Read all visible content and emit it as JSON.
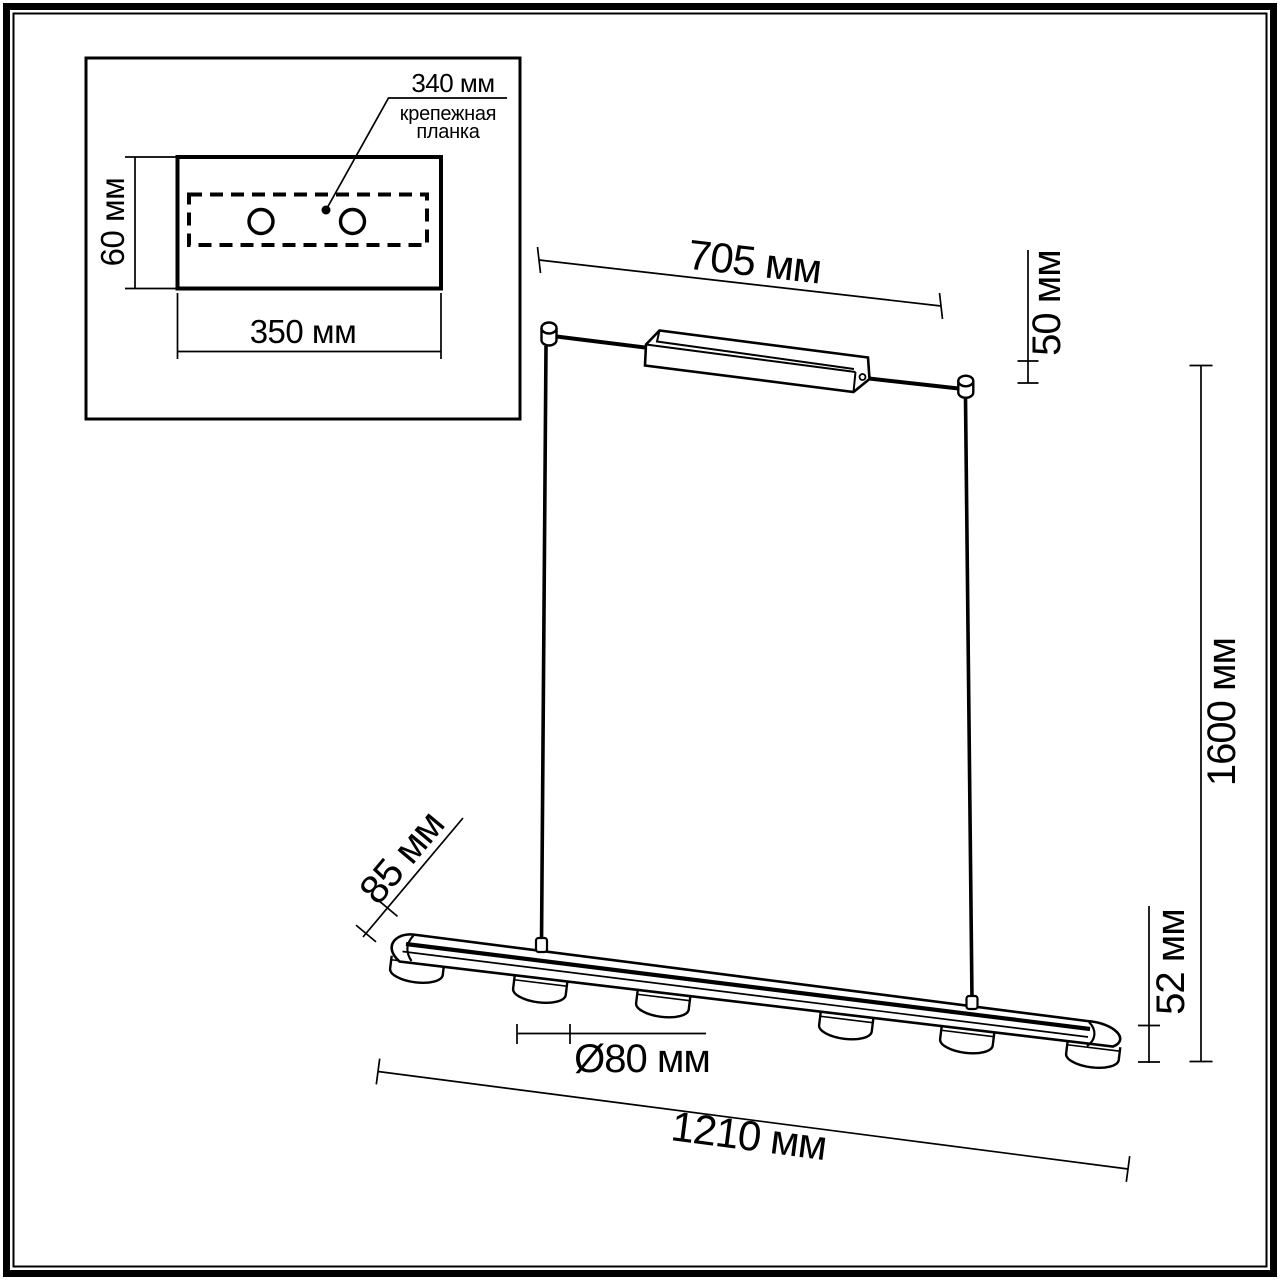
{
  "drawing_colors": {
    "line": "#000000",
    "background": "#ffffff"
  },
  "inset": {
    "bracket_length_label": "340 мм",
    "bracket_name_line1": "крепежная",
    "bracket_name_line2": "планка",
    "plate_height_label": "60 мм",
    "plate_width_label": "350 мм"
  },
  "fixture_dimensions": {
    "canopy_length_label": "705 мм",
    "canopy_drop_label": "50 мм",
    "suspension_height_label": "1600 мм",
    "bar_side_label": "85 мм",
    "spot_diameter_label": "Ø80 мм",
    "bar_height_label": "52 мм",
    "bar_length_label": "1210 мм"
  }
}
